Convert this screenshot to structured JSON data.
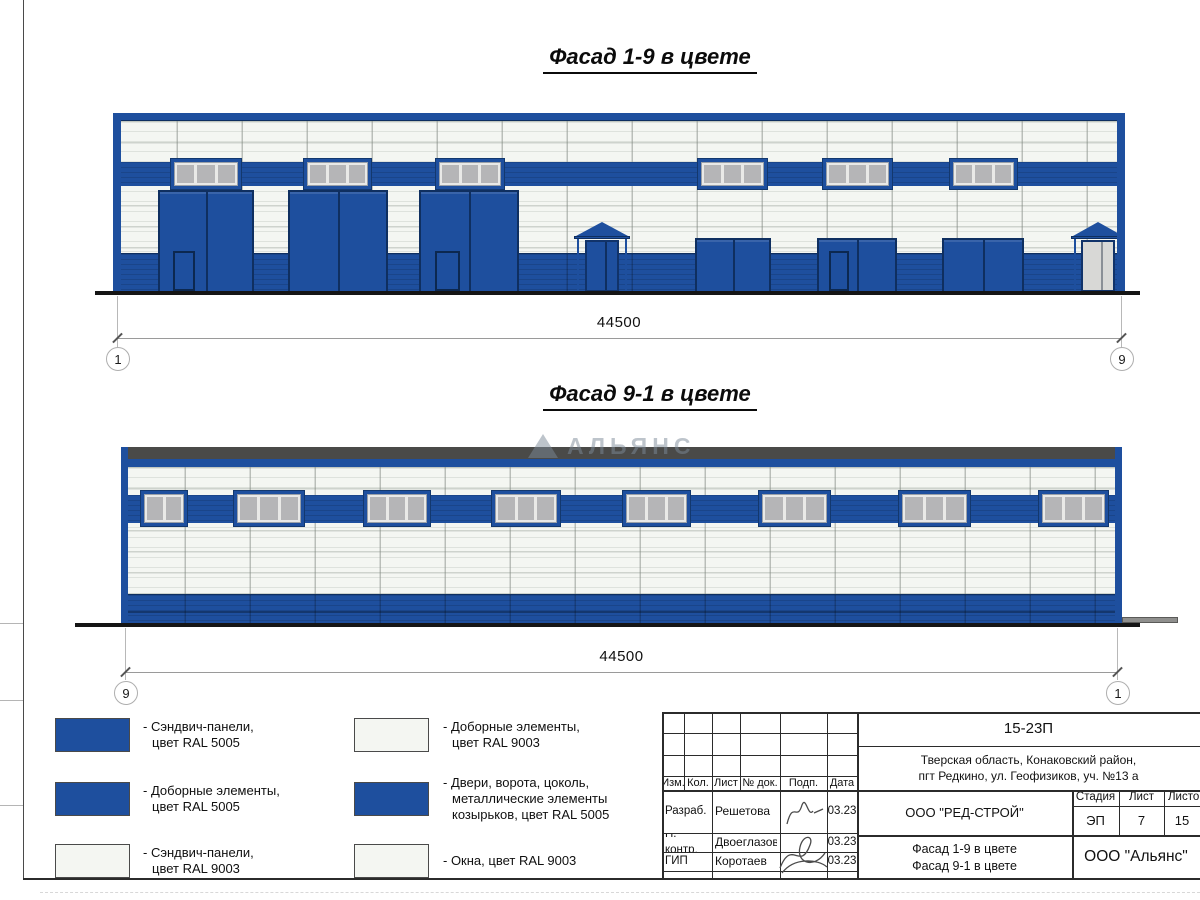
{
  "titles": {
    "facade19": "Фасад 1-9 в цвете",
    "facade91": "Фасад 9-1 в цвете"
  },
  "dimensions": {
    "facade19": {
      "value": "44500",
      "left_marker": "1",
      "right_marker": "9"
    },
    "facade91": {
      "value": "44500",
      "left_marker": "9",
      "right_marker": "1"
    }
  },
  "watermark": {
    "text": "АЛЬЯНС"
  },
  "colors": {
    "ral5005": "#1e4f9e",
    "ral5005_dark": "#11335f",
    "ral9003": "#f4f6f2",
    "window_gray": "#b5b5b7",
    "parapet": "#4a4a48"
  },
  "legend": {
    "items": [
      {
        "color": "blue",
        "text": "- Сэндвич-панели,\nцвет RAL 5005"
      },
      {
        "color": "blue",
        "text": "- Доборные элементы,\nцвет RAL 5005"
      },
      {
        "color": "white",
        "text": "- Сэндвич-панели,\nцвет RAL 9003"
      },
      {
        "color": "white",
        "text": "- Доборные элементы,\nцвет RAL 9003"
      },
      {
        "color": "blue",
        "text": "- Двери, ворота, цоколь,\nметаллические элементы\nкозырьков, цвет RAL 5005"
      },
      {
        "color": "white",
        "text": "- Окна, цвет RAL 9003"
      }
    ]
  },
  "title_block": {
    "code": "15-23П",
    "address": "Тверская область, Конаковский район,\nпгт Редкино, ул. Геофизиков, уч. №13 а",
    "header_cols": [
      "Изм.",
      "Кол.",
      "Лист",
      "№ док.",
      "Подп.",
      "Дата"
    ],
    "rows": [
      {
        "role": "Разраб.",
        "name": "Решетова",
        "date": "03.23"
      },
      {
        "role": "Н. контр.",
        "name": "Двоеглазов",
        "date": "03.23"
      },
      {
        "role": "ГИП",
        "name": "Коротаев",
        "date": "03.23"
      }
    ],
    "company": "ООО \"РЕД-СТРОЙ\"",
    "stage_label": "Стадия",
    "sheet_label": "Лист",
    "sheets_label": "Листов",
    "stage": "ЭП",
    "sheet": "7",
    "sheets": "15",
    "drawing_title": "Фасад 1-9 в цвете\nФасад 9-1 в цвете",
    "contractor": "ООО \"Альянс\""
  },
  "facade1": {
    "x": 113,
    "y": 113,
    "w": 1012,
    "h": 180,
    "top_strip_h": 8,
    "side_border_w": 8,
    "band": {
      "y": 49,
      "h": 24
    },
    "plinth": {
      "y": 140,
      "h": 40
    },
    "window_y": 45,
    "window_h": 32,
    "windows": [
      {
        "x": 57,
        "w": 72,
        "panes": 3
      },
      {
        "x": 190,
        "w": 69,
        "panes": 3
      },
      {
        "x": 322,
        "w": 70,
        "panes": 3
      },
      {
        "x": 584,
        "w": 71,
        "panes": 3
      },
      {
        "x": 709,
        "w": 71,
        "panes": 3
      },
      {
        "x": 836,
        "w": 69,
        "panes": 3
      }
    ],
    "gates": [
      {
        "x": 45,
        "w": 96,
        "top": 77,
        "door": {
          "x": 13,
          "w": 22
        }
      },
      {
        "x": 175,
        "w": 100,
        "top": 77
      },
      {
        "x": 306,
        "w": 100,
        "top": 77,
        "door": {
          "x": 14,
          "w": 25
        }
      },
      {
        "x": 582,
        "w": 76,
        "top": 125
      },
      {
        "x": 704,
        "w": 80,
        "top": 125,
        "door": {
          "x": 10,
          "w": 20
        }
      },
      {
        "x": 829,
        "w": 82,
        "top": 125
      }
    ],
    "door_h": 40,
    "entrance": {
      "apex_y": 109,
      "eave_y": 123,
      "door_w": 34,
      "door_top": 127
    },
    "entrances": [
      {
        "x": 463,
        "w": 52,
        "light": false
      },
      {
        "x": 960,
        "w": 50,
        "light": true
      }
    ],
    "ground": {
      "x1": 95,
      "x2": 1140,
      "y": 291
    }
  },
  "facade2": {
    "x": 121,
    "y": 444,
    "w": 1001,
    "h": 182,
    "parapet_dark": {
      "y": 3,
      "h": 12
    },
    "parapet_blue": {
      "y": 15,
      "h": 8
    },
    "side_border_w": 7,
    "band": {
      "y": 51,
      "h": 28
    },
    "window_y": 46,
    "window_h": 37,
    "windows": [
      {
        "x": 19,
        "w": 48,
        "panes": 2
      },
      {
        "x": 112,
        "w": 72,
        "panes": 3
      },
      {
        "x": 242,
        "w": 68,
        "panes": 3
      },
      {
        "x": 370,
        "w": 70,
        "panes": 3
      },
      {
        "x": 501,
        "w": 69,
        "panes": 3
      },
      {
        "x": 637,
        "w": 73,
        "panes": 3
      },
      {
        "x": 777,
        "w": 73,
        "panes": 3
      },
      {
        "x": 917,
        "w": 71,
        "panes": 3
      }
    ],
    "bottom_band": {
      "y": 150,
      "h": 32
    },
    "ground": {
      "x1": 75,
      "x2": 1140,
      "y": 623
    },
    "step": {
      "x": 1122,
      "w": 56,
      "y": 617,
      "h": 6
    }
  }
}
